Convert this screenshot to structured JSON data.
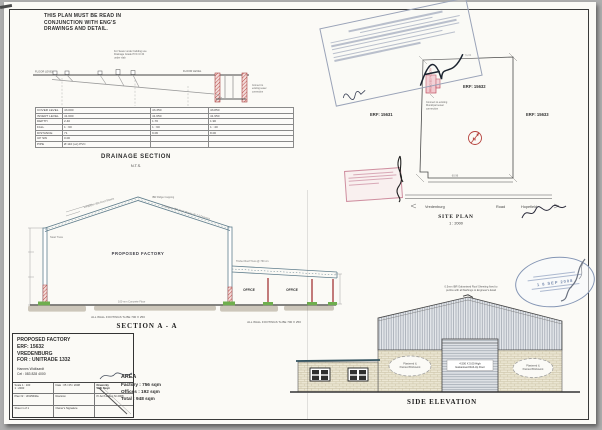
{
  "header_note": {
    "text": "THIS PLAN MUST BE READ IN\nCONJUNCTION WITH ENG'S\nDRAWINGS AND DETAIL."
  },
  "drainage": {
    "title": "DRAINAGE SECTION",
    "scale": "N.T.S.",
    "note1": "For Sewer under building use",
    "note2": "Drainage Grade PVC Cl 34",
    "note3": "under slab",
    "floor_level_left": "FLOOR LEVEL",
    "floor_level_right": "FLOOR LEVEL",
    "connect1": "Connect to",
    "connect2": "existing sewer",
    "connect3": "connection",
    "table": {
      "rows": [
        {
          "label": "COVER LEVEL",
          "c1": "43.000",
          "c2": "43.350",
          "c3": "43.850"
        },
        {
          "label": "INVERT LEVEL",
          "c1": "41.600",
          "c2": "41.650",
          "c3": "41.950"
        },
        {
          "label": "DEPTH",
          "c1": "2.40",
          "c2": "1.70",
          "c3": "1.90"
        },
        {
          "label": "FALL",
          "c1": "1 : 60",
          "c2": "1 : 60",
          "c3": "1 : 40"
        },
        {
          "label": "DISTANCE",
          "c1": "71",
          "c2": "9.06",
          "c3": "8.00"
        },
        {
          "label": "UP SW",
          "c1": "0.00",
          "c2": "",
          "c3": ""
        },
        {
          "label": "PIPE",
          "c1": "Ø 110 (uc) PVC",
          "c2": "",
          "c3": ""
        }
      ]
    }
  },
  "section_aa": {
    "title": "SECTION  A - A",
    "factory_label": "PROPOSED FACTORY",
    "office1": "OFFICE",
    "office2": "OFFICE",
    "apex_note": "IBR Ridge Capping",
    "left_slope_note": "Longspan IBR Roof Sheets",
    "right_slope_note": "Longspan IBR Roof Sheets @ 7.5 Degrees",
    "truss_note": "Steel Truss",
    "floor_note": "100 mm Concrete Floor",
    "lean_to_note": "Timber Roof Truss @ 760 crs",
    "footings_note_left": "ALL WALL FOOTINGS To BE 700 X 250",
    "footings_note_right": "ALL WALL FOOTINGS To BE 700 X 250"
  },
  "site_plan": {
    "title": "SITE PLAN",
    "scale": "1 : 2000",
    "erf_left": "ERF: 15631",
    "erf_center": "ERF: 15632",
    "erf_right": "ERF: 15633",
    "road_left": "Vredenburg",
    "road_center": "Road",
    "road_right": "Hopefield",
    "top_dim": "76.02",
    "bottom_dim": "60.96",
    "north_label": "N",
    "footprint_label": "PROPOSED FACTORY",
    "footprint_note1": "Connect to existing",
    "footprint_note2": "Municipal sewer",
    "footprint_note3": "connection"
  },
  "side_elevation": {
    "title": "SIDE ELEVATION",
    "roof_note1": "0.5mm IBR Galvanised Roof Sheeting fixed to",
    "roof_note2": "purlins with all flashings to Engineer's detail",
    "door_label1": "4.500 X 5.00 High",
    "door_label2": "Galvanised Roll-Up Door",
    "cloud_left1": "Plastered &",
    "cloud_left2": "Painted Brickwork",
    "cloud_right1": "Plastered &",
    "cloud_right2": "Painted Brickwork"
  },
  "stamps": {
    "oval_date": "1 8 SEP 2008"
  },
  "title_block": {
    "project": "PROPOSED FACTORY",
    "erf": "ERF: 15632",
    "town": "VREDENBURG",
    "client": "FOR : UNITRADE 1332",
    "contact_name": "Hannes Wolfaardt",
    "contact_cell": "Cel : 083 828 4000",
    "scale_label": "Scale 1 : 100\n1 : 2000",
    "date_label": "Date : 05 / 05 / 2008",
    "drawn_label": "Drawn By\nWilli Steyn",
    "plan_nr": "Plan Nr : UN15632a",
    "revision": "Revision",
    "reg": "Pr.Arch 2 Reg Nr 2008",
    "sheet": "Sheet 1 of 1",
    "owner_sig": "Owner's Signature"
  },
  "area_block": {
    "title": "AREA",
    "factory": "Factory : 756 sqm",
    "offices": "Offices : 192 sqm",
    "total": "Total : 948 sqm"
  }
}
